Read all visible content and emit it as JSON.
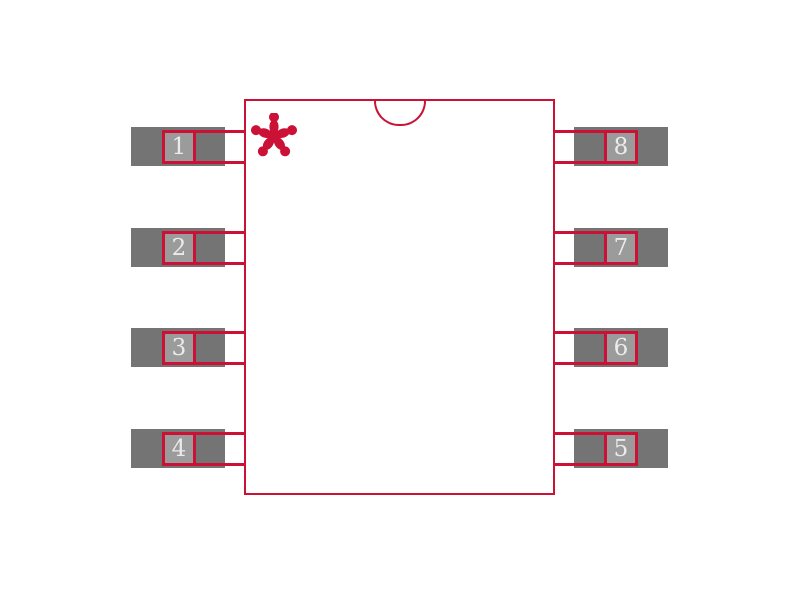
{
  "diagram": {
    "kind": "8-pin package outline drawing with pads",
    "pin1_marker_glyph": "*",
    "notch": "semicircle top-center",
    "colors": {
      "outline_red": "#cb1236",
      "pad_gray": "#747474",
      "pin_box_fill": "#9b9b9b",
      "pin_number_text": "#ebebeb",
      "background": "#ffffff"
    }
  },
  "pins": [
    {
      "number": "1",
      "side": "left",
      "row": 1
    },
    {
      "number": "2",
      "side": "left",
      "row": 2
    },
    {
      "number": "3",
      "side": "left",
      "row": 3
    },
    {
      "number": "4",
      "side": "left",
      "row": 4
    },
    {
      "number": "8",
      "side": "right",
      "row": 1
    },
    {
      "number": "7",
      "side": "right",
      "row": 2
    },
    {
      "number": "6",
      "side": "right",
      "row": 3
    },
    {
      "number": "5",
      "side": "right",
      "row": 4
    }
  ]
}
